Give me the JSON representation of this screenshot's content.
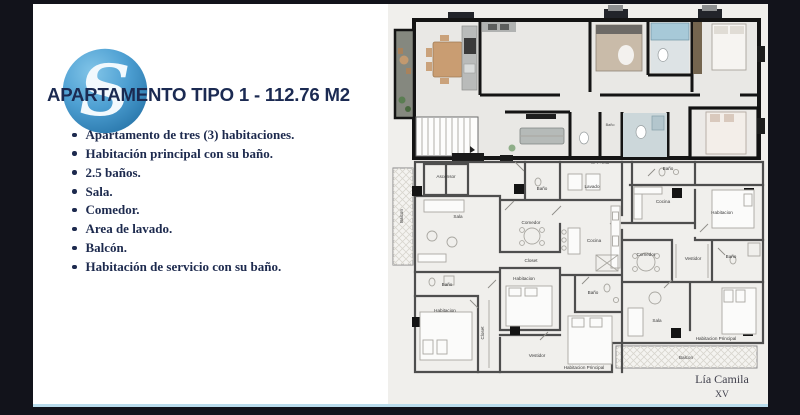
{
  "slide": {
    "title": "APARTAMENTO TIPO 1 - 112.76 M2",
    "logo_letter": "S",
    "bullets": [
      "Apartamento de tres (3) habitaciones.",
      "Habitación principal con su baño.",
      "2.5 baños.",
      "Sala.",
      "Comedor.",
      "Area de lavado.",
      "Balcón.",
      "Habitación de servicio con su baño."
    ],
    "colors": {
      "title_navy": "#1b2a52",
      "logo_blue": "#4d9fd2",
      "frame_dark": "#12131b",
      "bottom_accent": "#b9dcec",
      "plan_sheet": "#f0efec"
    }
  },
  "floorplan": {
    "npt": "NPT +0.48",
    "labels": {
      "bano_render": "Baño",
      "ascensor": "Ascensor",
      "balcon_left": "Balcon",
      "sala_a": "Sala",
      "bano_a1": "Baño",
      "lavado": "Lavado",
      "comedor_a": "Comedor",
      "cocina_a": "Cocina",
      "closet_a": "Closet",
      "habitacion_a": "Habitacion",
      "bano_a2": "Baño",
      "habitacion_a2": "Habitacion",
      "closet_a2": "Closet",
      "vestidor_a": "Vestidor",
      "habitacion_principal_a": "Habitacion Principal",
      "bano_a3": "Baño",
      "bano_b1": "Baño",
      "cocina_b": "Cocina",
      "habitacion_b1": "Habitacion",
      "comedor_b": "Comedor",
      "vestidor_b": "Vestidor",
      "bano_b2": "Baño",
      "sala_b": "Sala",
      "habitacion_principal_b": "Habitacion Principal",
      "balcon_b": "Balcon"
    },
    "watermark_line1": "Lía Camila",
    "watermark_line2": "XV"
  }
}
